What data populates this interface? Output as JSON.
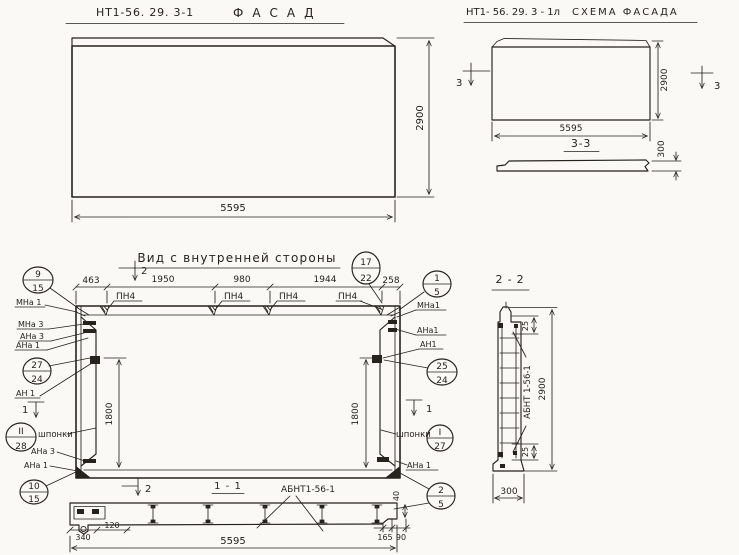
{
  "facade": {
    "code": "НТ1-56. 29. 3-1",
    "caption": "ФАСАД",
    "dim_width": "5595",
    "dim_height": "2900"
  },
  "schema": {
    "code": "НТ1- 56. 29. 3 - 1л",
    "caption": "СХЕМА ФАСАДА",
    "dim_width": "5595",
    "dim_height": "2900",
    "mark": "3",
    "section_title": "3-3",
    "dim_thickness": "300"
  },
  "inner": {
    "title": "Вид с внутренней стороны",
    "dims": {
      "d463": "463",
      "d1950": "1950",
      "d980": "980",
      "d1944": "1944",
      "d258": "258",
      "d1800": "1800"
    },
    "pn4": "ПН4",
    "shponki": "шпонки",
    "mark1": "1",
    "mark2": "2",
    "labels": {
      "mna1": "МНа 1",
      "mna3": "МНа 3",
      "ana3": "АНа 3",
      "ana1": "АНа 1",
      "an1": "АН 1",
      "mna1r": "МНа1",
      "ana1r": "АНа1",
      "an1r": "АН1",
      "ana1rb": "АНа 1"
    },
    "callouts": {
      "c17": {
        "t": "17",
        "b": "22"
      },
      "c9": {
        "t": "9",
        "b": "15"
      },
      "c1": {
        "t": "1",
        "b": "5"
      },
      "c27l": {
        "t": "27",
        "b": "24"
      },
      "c25r": {
        "t": "25",
        "b": "24"
      },
      "cII": {
        "t": "II",
        "b": "28"
      },
      "cI": {
        "t": "I",
        "b": "27"
      },
      "c10": {
        "t": "10",
        "b": "15"
      },
      "c2r": {
        "t": "2",
        "b": "5"
      }
    }
  },
  "s11": {
    "title": "1 - 1",
    "label": "АБНТ1-56-1",
    "d340": "340",
    "d120": "120",
    "d165": "165",
    "d90": "90",
    "d40": "40",
    "total": "5595"
  },
  "s22": {
    "title": "2 - 2",
    "label": "АБНТ 1-56-1",
    "d25": "25",
    "height": "2900",
    "width": "300"
  }
}
